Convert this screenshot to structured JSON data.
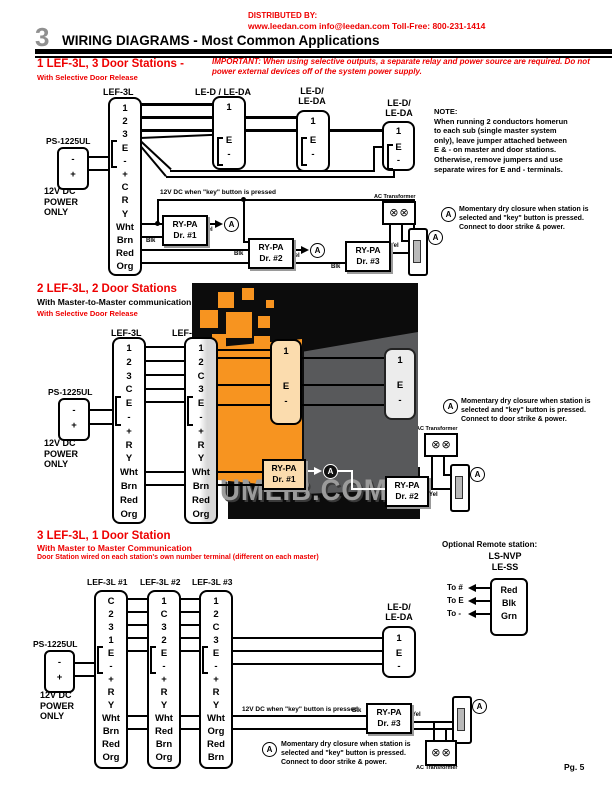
{
  "colors": {
    "red": "#ee0000",
    "section_number_gray": "#909090",
    "watermark_orange": "#f79420",
    "watermark_gray": "#58595b",
    "watermark_letters": "#9b9b9b",
    "door_tan": "#fbdcae"
  },
  "glyphs": {
    "a": "A",
    "screw": "⊗"
  },
  "header": {
    "distributed_by": "DISTRIBUTED BY:",
    "contact_line": "www.leedan.com   info@leedan.com   Toll-Free: 800-231-1414",
    "section_number": "3",
    "title": "WIRING DIAGRAMS - Most Common Applications"
  },
  "watermark": {
    "text": "UMLIB.COM"
  },
  "footer": {
    "page": "Pg. 5"
  },
  "s1": {
    "title": "1 LEF-3L, 3 Door Stations -",
    "subtitle": "With Selective Door Release",
    "important": "IMPORTANT: When using selective outputs, a separate relay and power source are required. Do not power external devices off of the system power supply.",
    "power": {
      "model": "PS-1225UL",
      "pins": "-\n+",
      "caption": "12V DC\nPOWER\nONLY"
    },
    "master": {
      "label": "LEF-3L",
      "terminals": "1\n2\n3\nE\n-\n+\nC\nR\nY\nWht\nBrn\nRed\nOrg"
    },
    "doors": [
      {
        "label": "LE-D / LE-DA",
        "top": "1",
        "jumper": "E\n-"
      },
      {
        "label": "LE-D/\nLE-DA",
        "top": "1",
        "jumper": "E\n-"
      },
      {
        "label": "LE-D/\nLE-DA",
        "top": "1",
        "jumper": "E\n-"
      }
    ],
    "note": "NOTE:\nWhen running 2 conductors homerun\nto each sub (single master system\nonly), leave jumper attached between\nE & - on master and door stations.\nOtherwise, remove jumpers and use\nseparate wires for E and - terminals.",
    "key_label": "12V DC when \"key\" button is pressed",
    "relays": [
      "RY-PA\nDr. #1",
      "RY-PA\nDr. #2",
      "RY-PA\nDr. #3"
    ],
    "blk": "Blk",
    "yel": "Yel",
    "transformer_label": "AC Transformer",
    "a_note": "Momentary dry closure when station is\nselected and \"key\" button is pressed.\nConnect to door strike & power."
  },
  "s2": {
    "title": "2 LEF-3L, 2 Door Stations",
    "subtitle": "With Master-to-Master communication",
    "subtitle2": "With Selective Door Release",
    "power": {
      "model": "PS-1225UL",
      "pins": "-\n+",
      "caption": "12V DC\nPOWER\nONLY"
    },
    "masters": [
      {
        "label": "LEF-3L",
        "terminals": "1\n2\n3\nC\nE\n-\n+\nR\nY\nWht\nBrn\nRed\nOrg"
      },
      {
        "label": "LEF-3L",
        "terminals": "1\n2\nC\n3\nE\n-\n+\nR\nY\nWht\nBrn\nRed\nOrg"
      }
    ],
    "doors": [
      {
        "top": "1",
        "jumper": "E\n-"
      },
      {
        "top": "1",
        "jumper": "E\n-"
      }
    ],
    "relays": [
      "RY-PA\nDr. #1",
      "RY-PA\nDr. #2"
    ],
    "blk": "Blk",
    "yel": "Yel",
    "transformer_label": "AC Transformer",
    "a_note": "Momentary dry closure when station is\nselected and \"key\" button is pressed.\nConnect to door strike & power."
  },
  "s3": {
    "title": "3 LEF-3L, 1 Door Station",
    "subtitle": "With Master to Master Communication",
    "subtitle2": "Door Station wired on each station's own number terminal (different on each master)",
    "power": {
      "model": "PS-1225UL",
      "pins": "-\n+",
      "caption": "12V DC\nPOWER\nONLY"
    },
    "masters": [
      {
        "label": "LEF-3L #1",
        "terminals": "C\n2\n3\n1\nE\n-\n+\nR\nY\nWht\nBrn\nRed\nOrg"
      },
      {
        "label": "LEF-3L #2",
        "terminals": "1\nC\n3\n2\nE\n-\n+\nR\nY\nWht\nRed\nBrn\nOrg"
      },
      {
        "label": "LEF-3L #3",
        "terminals": "1\n2\nC\n3\nE\n-\n+\nR\nY\nWht\nOrg\nRed\nBrn"
      }
    ],
    "door": {
      "label": "LE-D/\nLE-DA",
      "top": "1",
      "jumper": "E\n-"
    },
    "remote": {
      "caption": "Optional Remote station:",
      "model1": "LS-NVP",
      "model2": "LE-SS",
      "wires": "Red\nBlk\nGrn",
      "to1": "To #",
      "to2": "To E",
      "to3": "To -"
    },
    "key_label": "12V DC when \"key\" button is pressed",
    "relay": "RY-PA\nDr. #3",
    "blk": "Blk",
    "yel": "Yel",
    "transformer_label": "AC Transformer",
    "a_note": "Momentary dry closure when station is\nselected and \"key\" button is pressed.\nConnect to door strike & power.",
    "page": "Pg. 5"
  }
}
